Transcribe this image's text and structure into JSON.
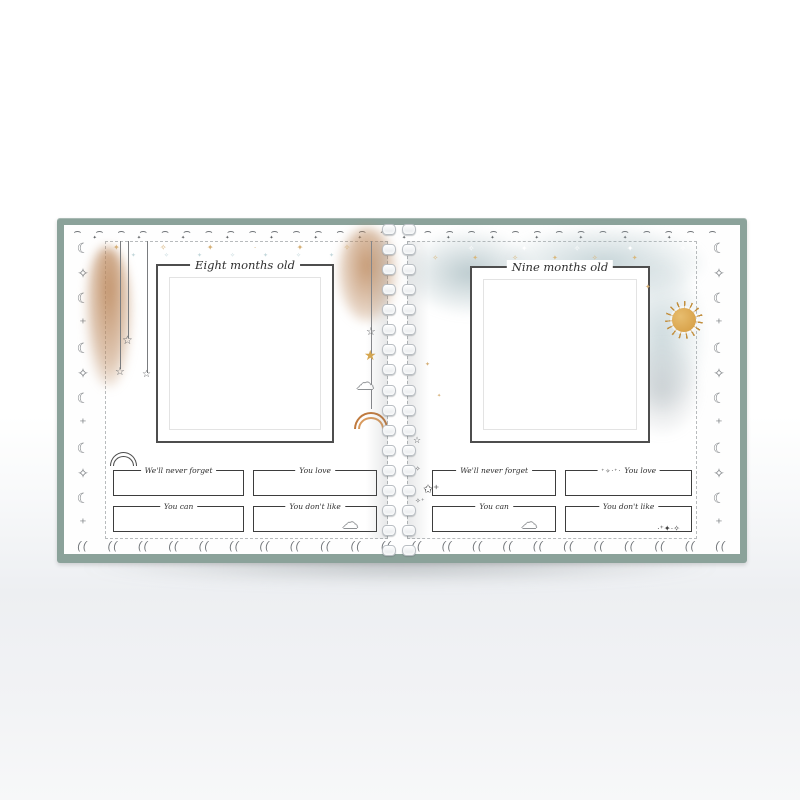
{
  "book": {
    "cover_color": "#8ba29a",
    "pages": [
      {
        "id": "left",
        "title": "Eight months old",
        "fields": [
          {
            "label": "We'll never forget"
          },
          {
            "label": "You love"
          },
          {
            "label": "You can"
          },
          {
            "label": "You don't like"
          }
        ]
      },
      {
        "id": "right",
        "title": "Nine months old",
        "fields": [
          {
            "label": "We'll never forget"
          },
          {
            "label": "You love"
          },
          {
            "label": "You can"
          },
          {
            "label": "You don't like"
          }
        ]
      }
    ],
    "colors": {
      "watercolor_brown": "#ba8558",
      "watercolor_blue": "#9cb5bb",
      "sun_gold": "#d49a3f",
      "star_gold": "#d7a74e"
    },
    "decor": {
      "moon_column": "☾✧☾⁺☾✧☾⁺☾✧☾⁺☾",
      "top_scallops": "⌢⌢⌢⌢⌢⌢⌢⌢⌢⌢⌢⌢⌢⌢⌢⌢⌢⌢⌢⌢⌢⌢⌢⌢⌢⌢⌢⌢⌢⌢",
      "top_diamonds": "✦✦✦✦✦✦✦✦✦✦✦✦✦✦",
      "bottom_arcs": "(( (( (( (( (( (( (( (( (( (( (( (( (( (( (( (( (( (( (( (( (( ((",
      "star_outline": "☆",
      "star_gold": "★",
      "cloud": "☁",
      "sparkle_cluster": "⁺✧·⁺·",
      "star_doodle": "✩⁺",
      "sparkle_row": "·⁺✦·✧",
      "spine_sparkle_a": "☆",
      "spine_sparkle_b": "⁺✧",
      "spine_sparkle_c": "✧⁺",
      "gold_speck": "✦",
      "gold_scatter": "✦ ✧ ✦ · ✦ ✧ ✦ · ✦ ✧",
      "blue_scatter": "✦✧✦✧✦✧✦",
      "white_scatter": "✦ ✧ ✦ ✧ ✦ ✧ ✦",
      "gold_scatter2": "✧✦✧✦✧✦"
    }
  }
}
